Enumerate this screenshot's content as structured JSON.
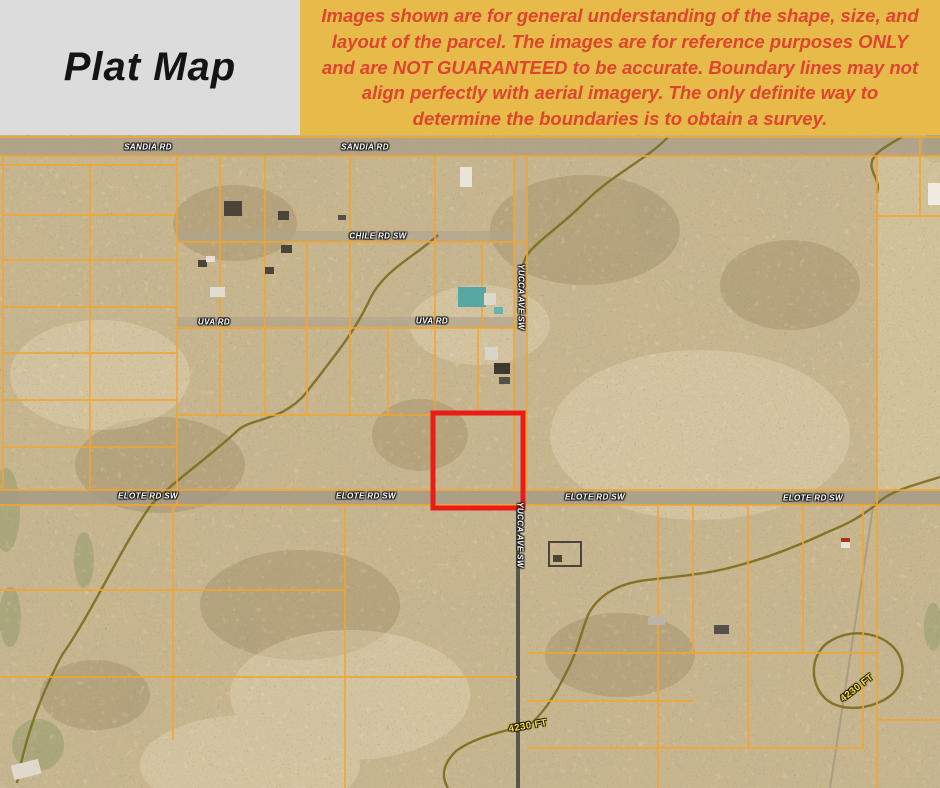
{
  "header": {
    "title": "Plat Map",
    "disclaimer": "Images shown are for general understanding of the shape, size, and layout of the parcel. The images are for reference purposes ONLY and are NOT GUARANTEED to be accurate. Boundary lines may not align perfectly with aerial imagery. The only definite way to determine the boundaries is to obtain a survey."
  },
  "colors": {
    "title_panel_bg": "#dcdcdc",
    "banner_bg": "#e6bb49",
    "banner_text": "#df4430",
    "parcel_line": "#f2a52f",
    "highlight_box": "#ea1c15",
    "road_label_text": "#ffffff",
    "elevation_label_text": "#f2df3c"
  },
  "map": {
    "description": "aerial plat map with parcel grid and highlighted lot",
    "road_labels": [
      {
        "text": "SANDIA RD",
        "x": 148,
        "y": 12,
        "rot": 0
      },
      {
        "text": "SANDIA RD",
        "x": 365,
        "y": 12,
        "rot": 0
      },
      {
        "text": "CHILE RD SW",
        "x": 378,
        "y": 101,
        "rot": 0
      },
      {
        "text": "UVA RD",
        "x": 214,
        "y": 187,
        "rot": 0
      },
      {
        "text": "UVA RD",
        "x": 432,
        "y": 186,
        "rot": 0
      },
      {
        "text": "YUCCA AVE SW",
        "x": 521,
        "y": 162,
        "rot": 90
      },
      {
        "text": "YUCCA AVE SW",
        "x": 520,
        "y": 400,
        "rot": 90
      },
      {
        "text": "ELOTE RD SW",
        "x": 148,
        "y": 361,
        "rot": 0
      },
      {
        "text": "ELOTE RD SW",
        "x": 366,
        "y": 361,
        "rot": 0
      },
      {
        "text": "ELOTE RD SW",
        "x": 595,
        "y": 362,
        "rot": 0
      },
      {
        "text": "ELOTE RD SW",
        "x": 813,
        "y": 363,
        "rot": 0
      }
    ],
    "elevation_labels": [
      {
        "text": "4230 FT",
        "x": 528,
        "y": 591,
        "rot": -10
      },
      {
        "text": "4230 FT",
        "x": 857,
        "y": 553,
        "rot": -38
      }
    ],
    "highlight_parcel": {
      "x": 433,
      "y": 278,
      "width": 90,
      "height": 95
    }
  }
}
